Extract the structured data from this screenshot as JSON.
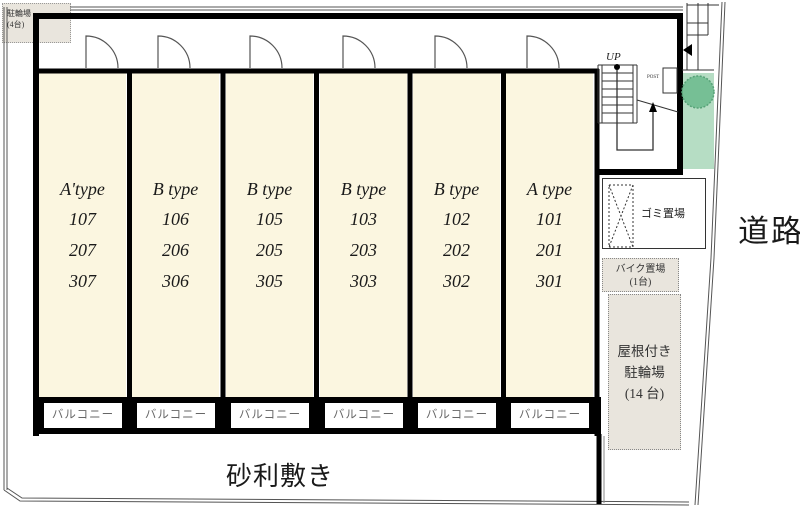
{
  "site": {
    "road_label": "道路",
    "gravel_label": "砂利敷き",
    "balcony_label": "バルコニー",
    "top_left_parking": {
      "name": "駐輪場",
      "capacity": "(4台)"
    },
    "garbage_label": "ゴミ置場",
    "bike_parking": {
      "name": "バイク置場",
      "capacity": "(1台)"
    },
    "covered_parking": {
      "line1": "屋根付き",
      "line2": "駐輪場",
      "capacity": "(14 台)"
    },
    "stairs": {
      "up_label": "UP",
      "post_label": "POST"
    }
  },
  "building": {
    "units": [
      {
        "type": "A'type",
        "rooms": [
          "107",
          "207",
          "307"
        ]
      },
      {
        "type": "B type",
        "rooms": [
          "106",
          "206",
          "306"
        ]
      },
      {
        "type": "B type",
        "rooms": [
          "105",
          "205",
          "305"
        ]
      },
      {
        "type": "B type",
        "rooms": [
          "103",
          "203",
          "303"
        ]
      },
      {
        "type": "B type",
        "rooms": [
          "102",
          "202",
          "302"
        ]
      },
      {
        "type": "A type",
        "rooms": [
          "101",
          "201",
          "301"
        ]
      }
    ]
  },
  "colors": {
    "unit_fill": "#fbf6e0",
    "beige_fill": "#e9e5dd",
    "green_strip": "#b6ddc4",
    "tree_green": "#76bf95",
    "wall": "#000000",
    "balcony_text": "#666666"
  }
}
